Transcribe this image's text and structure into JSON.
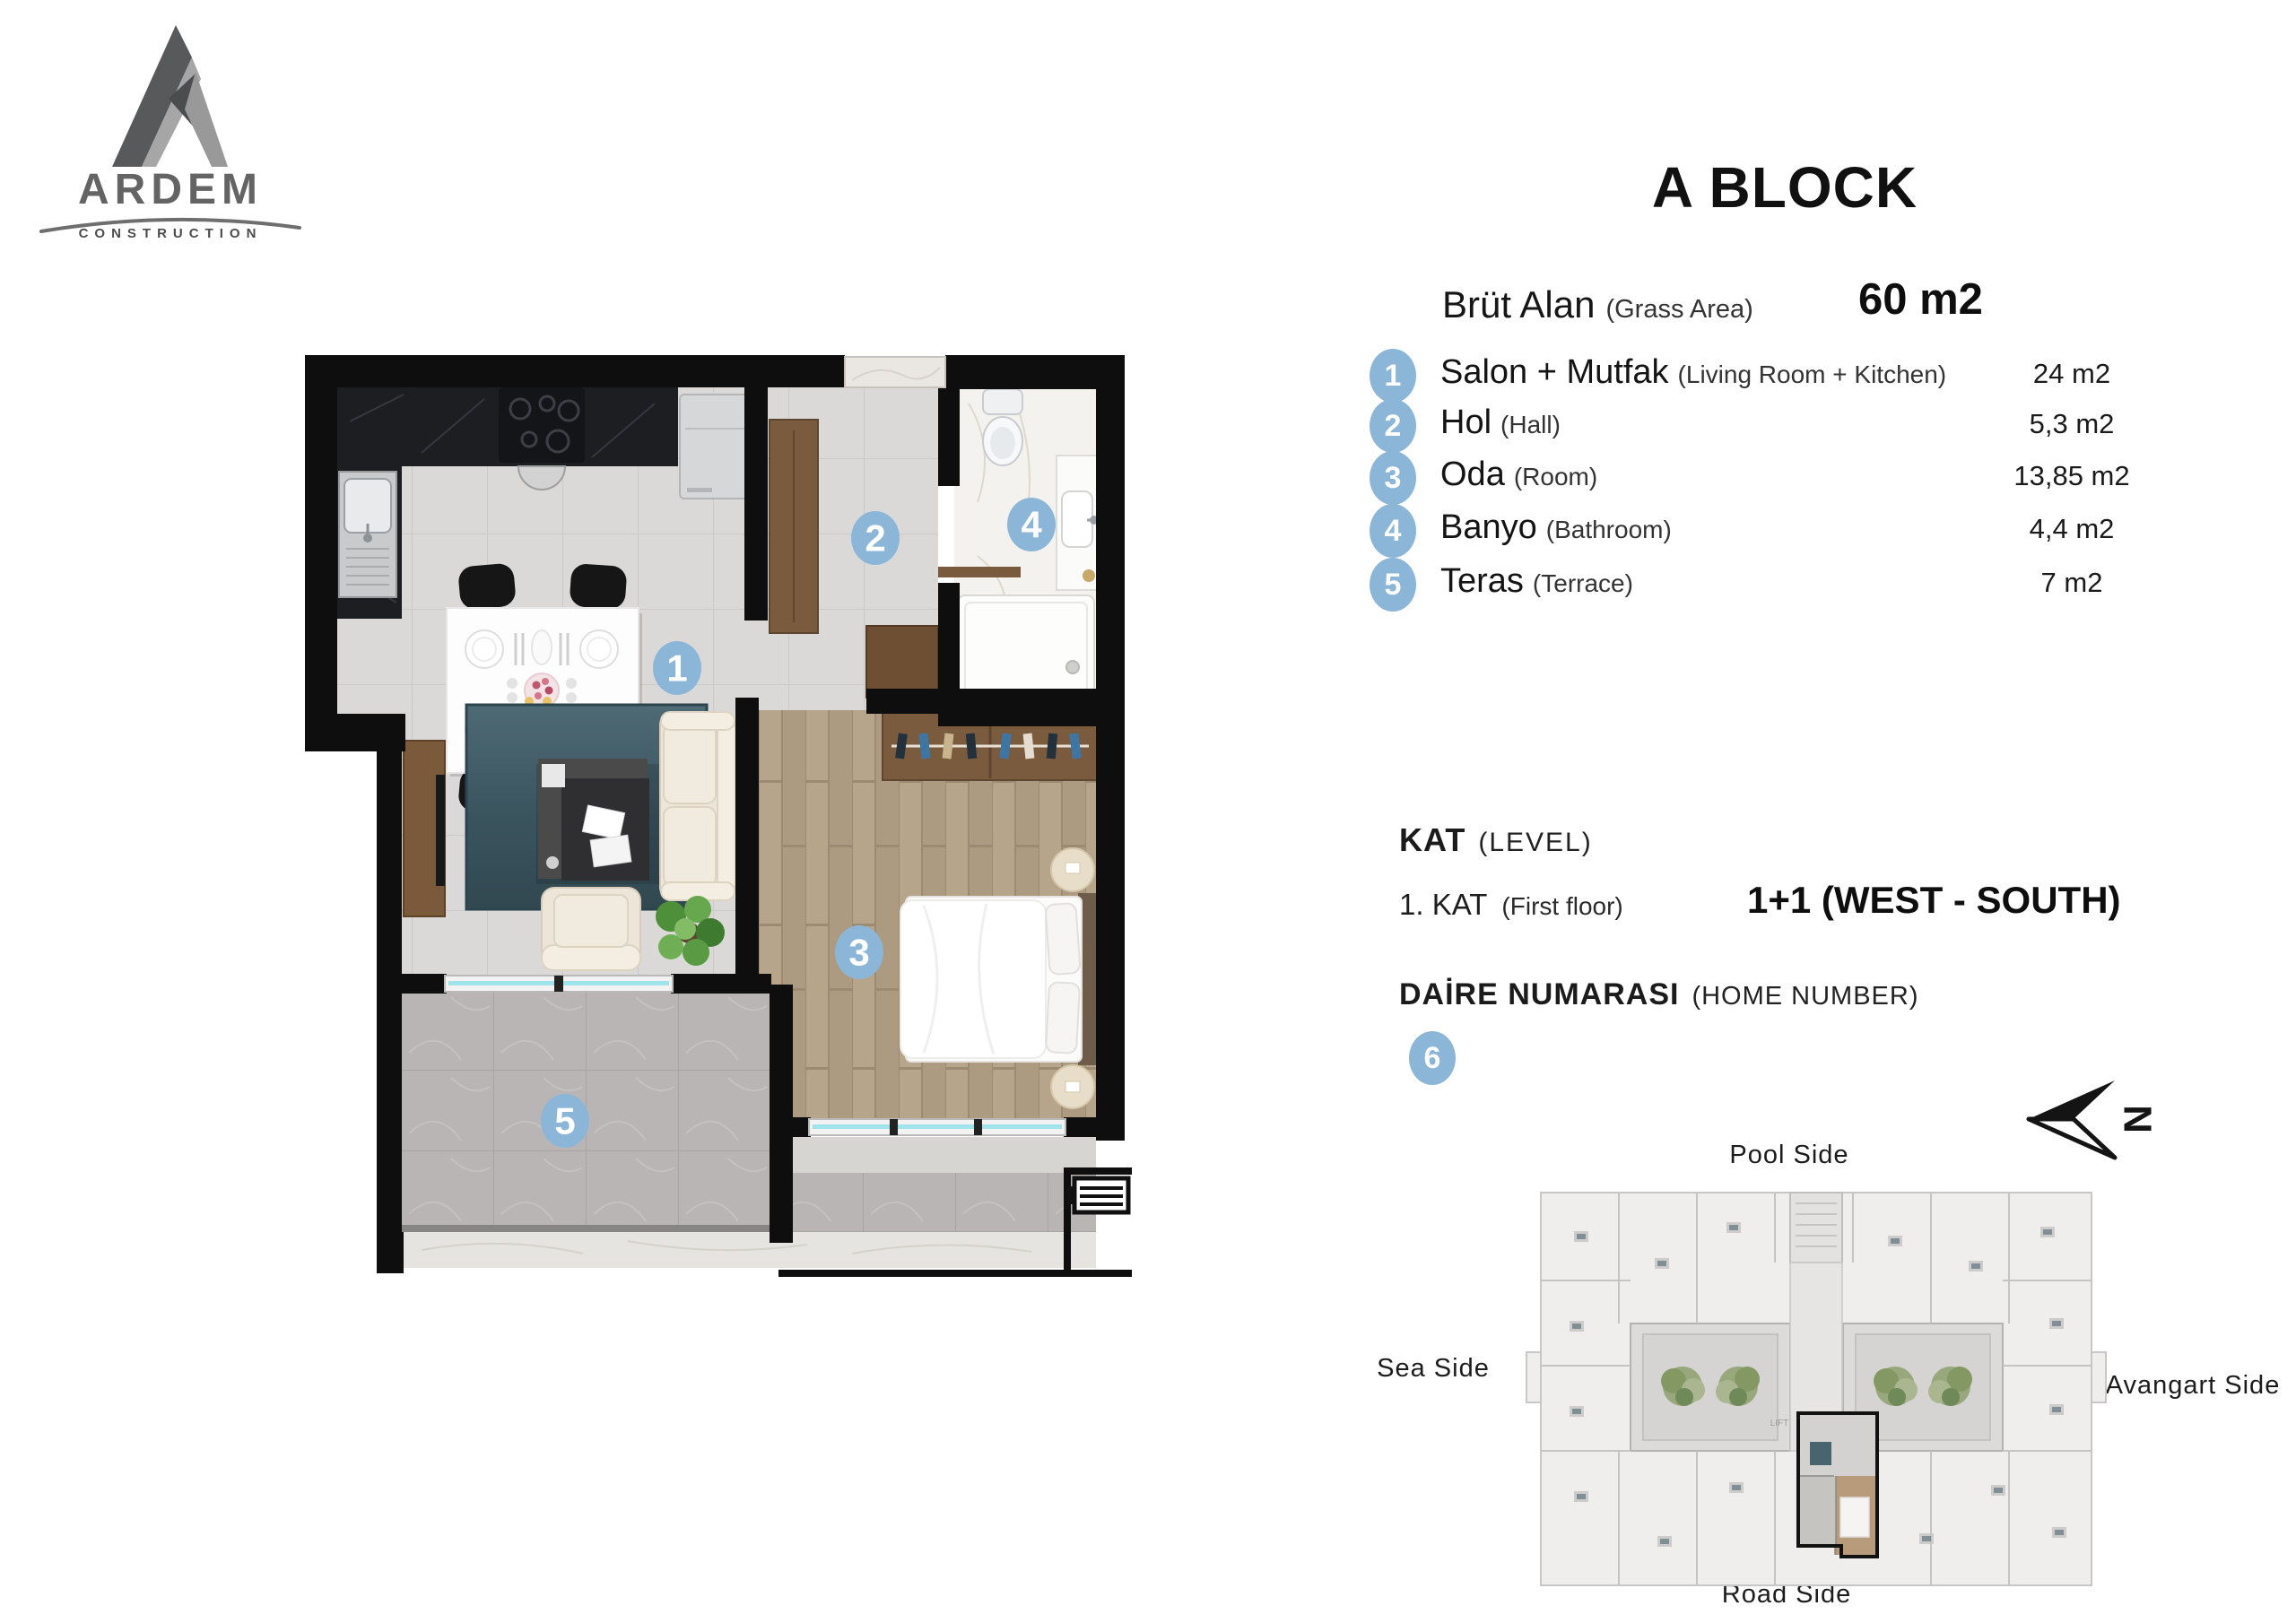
{
  "logo": {
    "brand": "ARDEM",
    "subtitle": "CONSTRUCTION"
  },
  "title": "A BLOCK",
  "gross_area": {
    "label": "Brüt Alan",
    "label_en": "(Grass Area)",
    "value": "60 m2"
  },
  "rooms": [
    {
      "num": "1",
      "name": "Salon + Mutfak",
      "name_en": "(Living Room + Kitchen)",
      "area": "24 m2"
    },
    {
      "num": "2",
      "name": "Hol",
      "name_en": "(Hall)",
      "area": "5,3 m2"
    },
    {
      "num": "3",
      "name": "Oda",
      "name_en": "(Room)",
      "area": "13,85 m2"
    },
    {
      "num": "4",
      "name": "Banyo",
      "name_en": "(Bathroom)",
      "area": "4,4 m2"
    },
    {
      "num": "5",
      "name": "Teras",
      "name_en": "(Terrace)",
      "area": "7 m2"
    }
  ],
  "level": {
    "label": "KAT",
    "label_en": "(LEVEL)",
    "value": "1. KAT",
    "value_en": "(First floor)",
    "plan_type": "1+1 (WEST - SOUTH)"
  },
  "home_number": {
    "label": "DAİRE NUMARASI",
    "label_en": "(HOME NUMBER)",
    "value": "6"
  },
  "compass": {
    "north": "N"
  },
  "site_plan": {
    "pool": "Pool Side",
    "sea": "Sea Side",
    "avangart": "Avangart Side",
    "road": "Road Side",
    "lift": "LIFT"
  },
  "colors": {
    "badge_blue": "#8cb6d8",
    "window_glass": "#9fe4ea",
    "rug_teal": "#41606b",
    "wood_floor": "#b4a289",
    "counter_dark": "#1c1e22",
    "highlight_outline": "#121212"
  }
}
